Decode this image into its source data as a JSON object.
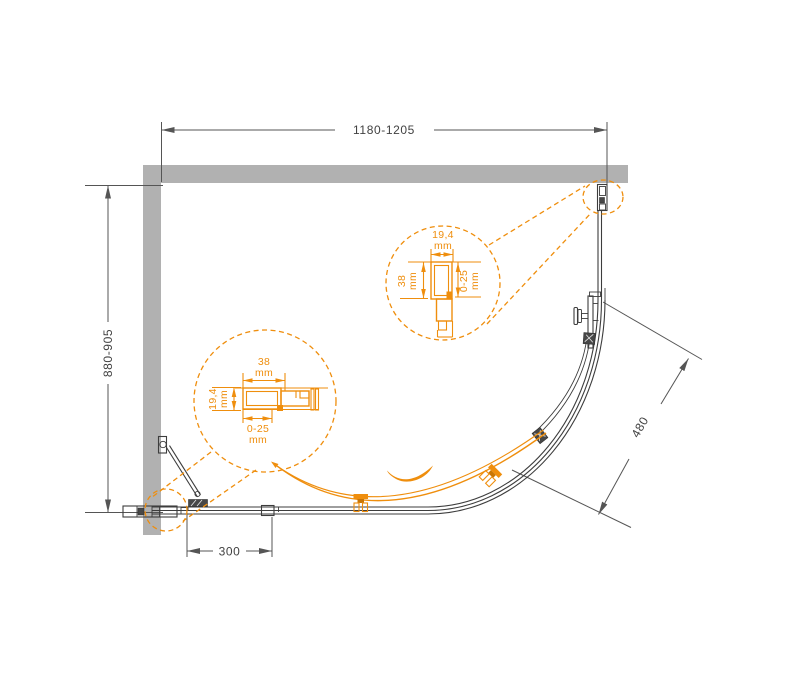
{
  "title": "Quadrant shower enclosure — top view installation diagram",
  "dimensions": {
    "width": "1180-1205",
    "depth": "880-905",
    "radius": "480",
    "panel": "300"
  },
  "detail_left": {
    "top_value": "38",
    "top_unit": "mm",
    "side_value": "19,4",
    "side_unit": "mm",
    "bottom_value": "0-25",
    "bottom_unit": "mm"
  },
  "detail_right": {
    "top_value": "19,4",
    "top_unit": "mm",
    "left_value": "38",
    "left_unit": "mm",
    "right_value": "0-25",
    "right_unit": "mm"
  },
  "colors": {
    "accent": "#EF8E0D",
    "accent2": "#C97606",
    "wall": "#B1B1B1",
    "line": "#3D3D3D",
    "dim": "#555555",
    "txt": "#414141"
  }
}
